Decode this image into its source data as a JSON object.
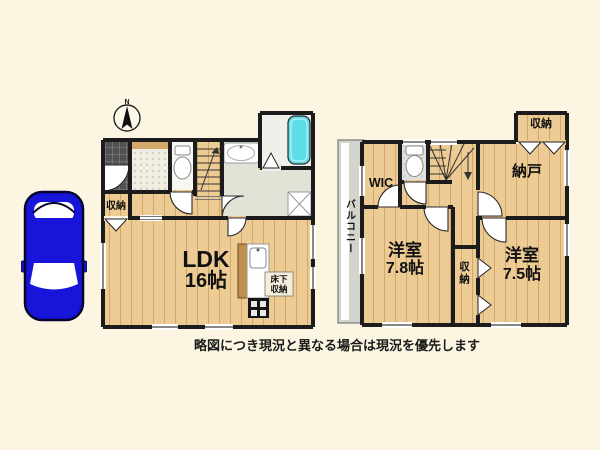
{
  "colors": {
    "background": "#fbf5e2",
    "wall": "#1c1c1c",
    "wood_floor": "#eccb95",
    "bathtub_cyan": "#5edee8",
    "washroom_green": "#dfe4d7",
    "balcony_gray": "#d5d4cc",
    "car_blue": "#1814da"
  },
  "compass": {
    "north_label": "N"
  },
  "floor1": {
    "entrance_closet_label": "収納",
    "ldk_label": "LDK",
    "ldk_size": "16帖",
    "underfloor_storage_label": "床下収納"
  },
  "floor2": {
    "wic_label": "WIC",
    "top_closet_label": "収納",
    "storage_room_label": "納戸",
    "bedroom_left_label": "洋室",
    "bedroom_left_size": "7.8帖",
    "middle_closet_label": "収納",
    "bedroom_right_label": "洋室",
    "bedroom_right_size": "7.5帖",
    "balcony_label": "バルコニー"
  },
  "footer": {
    "note": "略図につき現況と異なる場合は現況を優先します"
  }
}
